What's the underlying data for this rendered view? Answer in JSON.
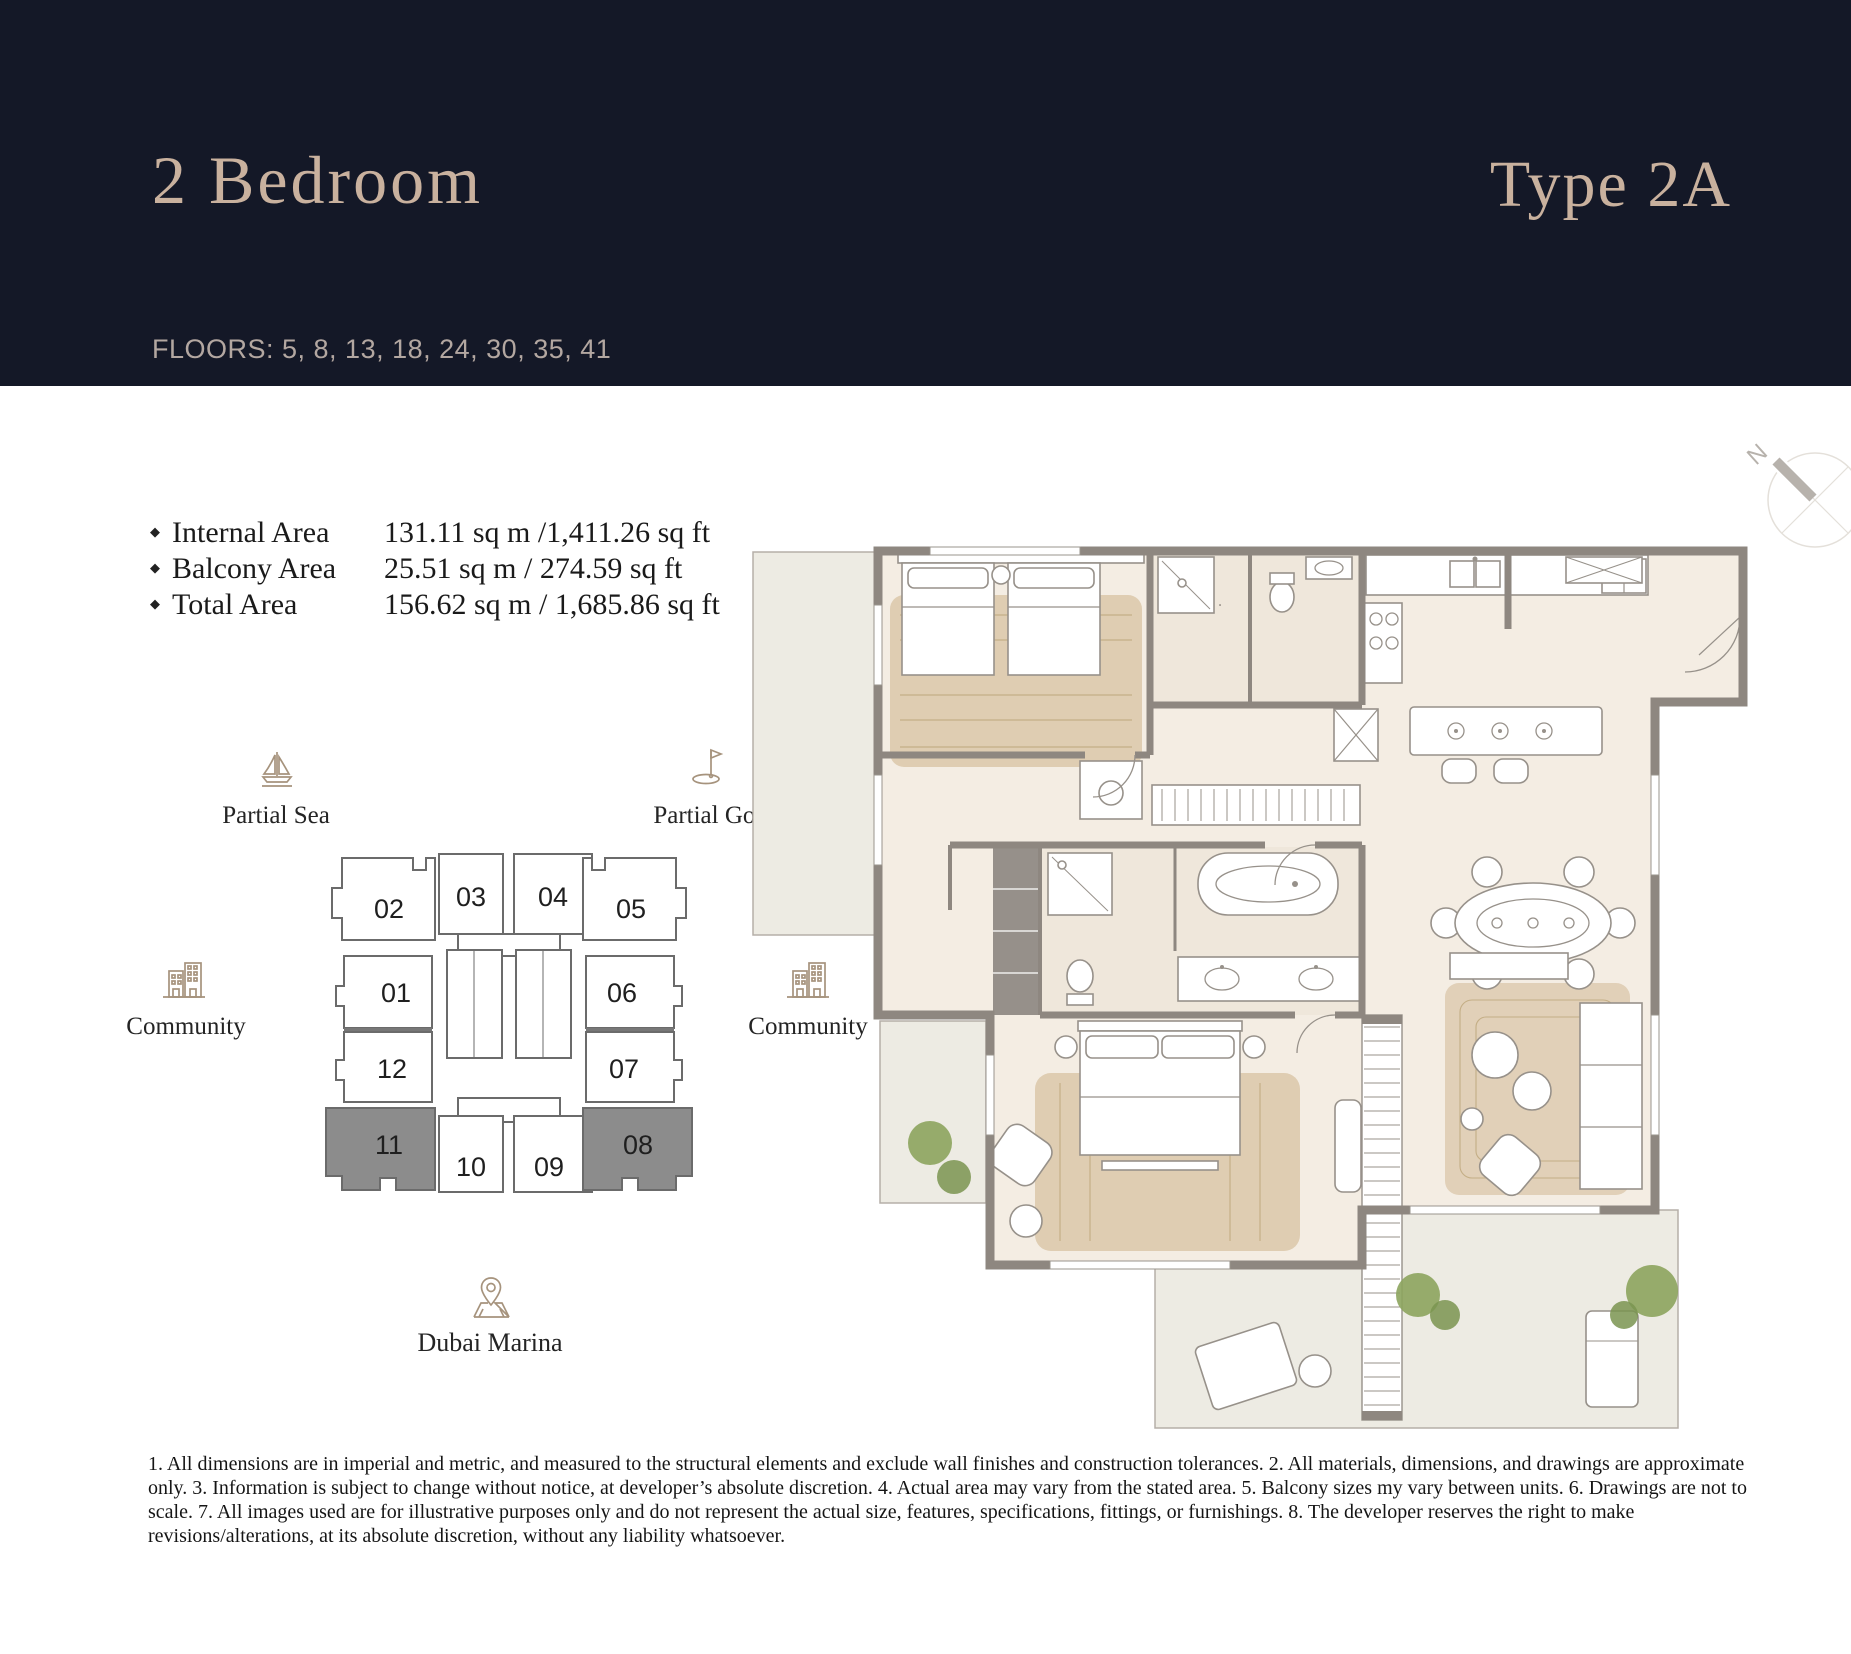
{
  "header": {
    "title": "2 Bedroom",
    "unit_type": "Type 2A",
    "floors_line": "FLOORS: 5, 8, 13, 18, 24, 30, 35, 41"
  },
  "areas": {
    "bullet": "◆",
    "items": [
      {
        "label": "Internal Area",
        "value": "131.11 sq m /1,411.26 sq ft"
      },
      {
        "label": "Balcony Area",
        "value": "25.51 sq m / 274.59 sq ft"
      },
      {
        "label": "Total Area",
        "value": "156.62 sq m / 1,685.86 sq ft"
      }
    ]
  },
  "key_plan": {
    "labels": {
      "sea": "Partial Sea",
      "golf": "Partial Golf",
      "community_left": "Community",
      "community_right": "Community",
      "marina": "Dubai Marina"
    },
    "units": [
      "02",
      "03",
      "04",
      "05",
      "01",
      "06",
      "12",
      "07",
      "11",
      "10",
      "09",
      "08"
    ],
    "highlighted_units": [
      "11",
      "08"
    ],
    "highlight_color": "#8C8C8C"
  },
  "compass": {
    "label": "N"
  },
  "disclaimer": "1. All dimensions are in imperial and metric, and measured to the structural elements and exclude wall finishes and construction tolerances. 2. All materials, dimensions, and drawings are approximate only. 3. Information is subject to change without notice, at developer’s absolute discretion. 4. Actual area may vary from the stated area. 5. Balcony sizes my vary between units. 6. Drawings are not to scale. 7. All images used are for illustrative purposes only and do not represent the actual size, features, specifications, fittings, or furnishings. 8. The developer reserves the right to make revisions/alterations, at its absolute discretion, without any liability whatsoever.",
  "colors": {
    "header_bg": "#141827",
    "accent_text": "#C9B19E",
    "floors_text": "#B3A7A1",
    "icon": "#A6937D",
    "wall": "#8E8780",
    "floor": "#F4EDE3",
    "balcony": "#EDEBE3",
    "rug": "#C9AE82",
    "tree": "#8CA45D"
  }
}
